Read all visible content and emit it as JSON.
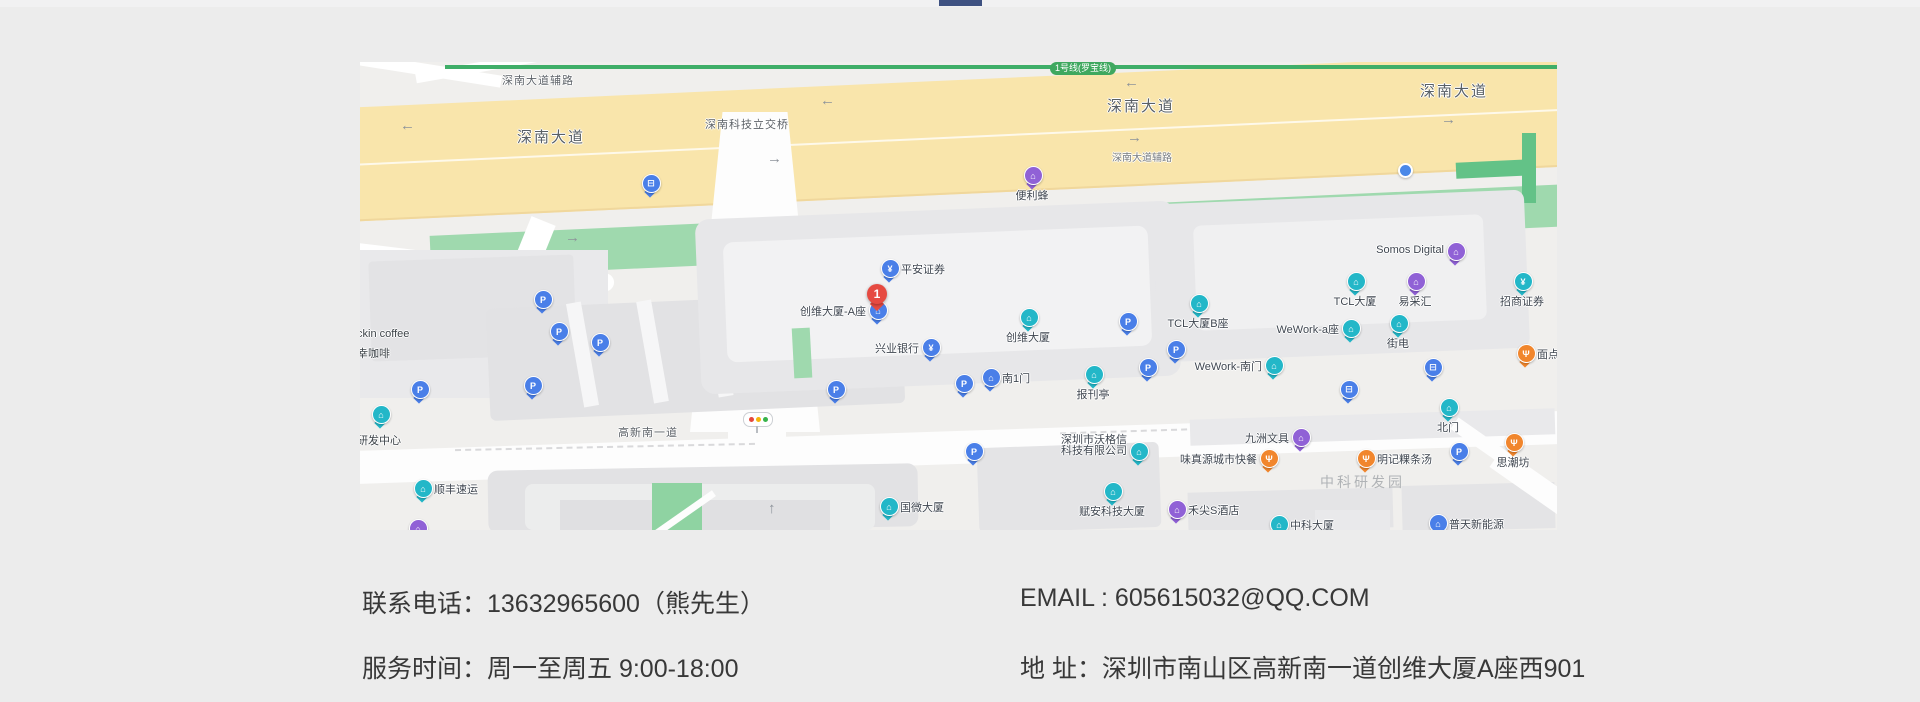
{
  "page": {
    "accent_color": "#3e5181"
  },
  "map": {
    "colors": {
      "teal": "#23b7c8",
      "blue": "#4a7fe8",
      "purple": "#9061d6",
      "orange": "#f1862d",
      "red": "#e64a41",
      "dotblue": "#4a88e8"
    },
    "metro_line_badge": "1号线(罗宝线)",
    "road_labels": [
      {
        "text": "深南大道辅路",
        "x": 142,
        "y": 10,
        "cls": "sm"
      },
      {
        "text": "深南大道",
        "x": 157,
        "y": 64,
        "cls": "lg"
      },
      {
        "text": "深南科技立交桥",
        "x": 345,
        "y": 54,
        "cls": "sm"
      },
      {
        "text": "深南大道",
        "x": 747,
        "y": 33,
        "cls": "lg"
      },
      {
        "text": "深南大道辅路",
        "x": 752,
        "y": 87,
        "cls": "xs"
      },
      {
        "text": "深南大道",
        "x": 1060,
        "y": 18,
        "cls": "lg"
      },
      {
        "text": "高新南一道",
        "x": 258,
        "y": 362,
        "cls": "sm"
      },
      {
        "text": "中科研发园",
        "x": 960,
        "y": 410,
        "cls": "area"
      },
      {
        "text": "ckin coffee",
        "x": -3,
        "y": 266,
        "cls": "poiLbl"
      },
      {
        "text": "幸咖啡",
        "x": -3,
        "y": 283,
        "cls": "poiLbl"
      },
      {
        "text": "想研发中心",
        "x": -14,
        "y": 370,
        "cls": "poiLbl"
      }
    ],
    "arrows": [
      {
        "dir": "left",
        "x": 40,
        "y": 55
      },
      {
        "dir": "right",
        "x": 205,
        "y": 167
      },
      {
        "dir": "left",
        "x": 460,
        "y": 30
      },
      {
        "dir": "right",
        "x": 407,
        "y": 88
      },
      {
        "dir": "left",
        "x": 764,
        "y": 12
      },
      {
        "dir": "right",
        "x": 767,
        "y": 67
      },
      {
        "dir": "right",
        "x": 1081,
        "y": 49
      },
      {
        "dir": "up",
        "x": 408,
        "y": 438
      }
    ],
    "marker": {
      "number": "1",
      "x": 517,
      "y": 250
    },
    "pois": [
      {
        "name": "bus-stop-pin",
        "label": "",
        "color": "blue",
        "glyph": "bus",
        "x": 290,
        "y": 126,
        "lp": "none"
      },
      {
        "name": "poi-bianlifeng",
        "label": "便利蜂",
        "color": "purple",
        "glyph": "building",
        "x": 672,
        "y": 118,
        "lp": "below"
      },
      {
        "name": "poi-pingan-securities",
        "label": "平安证券",
        "color": "blue",
        "glyph": "bank",
        "x": 529,
        "y": 211,
        "lp": "right"
      },
      {
        "name": "poi-skyworth-tower-a",
        "label": "创维大厦-A座",
        "color": "blue",
        "glyph": "building",
        "x": 517,
        "y": 253,
        "lp": "left"
      },
      {
        "name": "poi-cib-bank",
        "label": "兴业银行",
        "color": "blue",
        "glyph": "bank",
        "x": 570,
        "y": 290,
        "lp": "left"
      },
      {
        "name": "poi-skyworth-tower",
        "label": "创维大厦",
        "color": "teal",
        "glyph": "building",
        "x": 668,
        "y": 260,
        "lp": "below"
      },
      {
        "name": "poi-south-gate-1",
        "label": "南1门",
        "color": "blue",
        "glyph": "building",
        "x": 630,
        "y": 320,
        "lp": "right"
      },
      {
        "name": "poi-kiosk",
        "label": "报刊亭",
        "color": "teal",
        "glyph": "building",
        "x": 733,
        "y": 317,
        "lp": "below"
      },
      {
        "name": "parking-pin",
        "label": "",
        "color": "blue",
        "glyph": "parking",
        "x": 182,
        "y": 242,
        "lp": "none"
      },
      {
        "name": "parking-pin",
        "label": "",
        "color": "blue",
        "glyph": "parking",
        "x": 198,
        "y": 274,
        "lp": "none"
      },
      {
        "name": "parking-pin",
        "label": "",
        "color": "blue",
        "glyph": "parking",
        "x": 239,
        "y": 285,
        "lp": "none"
      },
      {
        "name": "parking-pin",
        "label": "",
        "color": "blue",
        "glyph": "parking",
        "x": 59,
        "y": 332,
        "lp": "none"
      },
      {
        "name": "parking-pin",
        "label": "",
        "color": "blue",
        "glyph": "parking",
        "x": 172,
        "y": 328,
        "lp": "none"
      },
      {
        "name": "parking-pin",
        "label": "",
        "color": "blue",
        "glyph": "parking",
        "x": 475,
        "y": 332,
        "lp": "none"
      },
      {
        "name": "parking-pin",
        "label": "",
        "color": "blue",
        "glyph": "parking",
        "x": 603,
        "y": 326,
        "lp": "none"
      },
      {
        "name": "parking-pin",
        "label": "",
        "color": "blue",
        "glyph": "parking",
        "x": 767,
        "y": 264,
        "lp": "none"
      },
      {
        "name": "parking-pin",
        "label": "",
        "color": "blue",
        "glyph": "parking",
        "x": 613,
        "y": 394,
        "lp": "none"
      },
      {
        "name": "parking-pin",
        "label": "",
        "color": "blue",
        "glyph": "parking",
        "x": 815,
        "y": 292,
        "lp": "none"
      },
      {
        "name": "parking-pin",
        "label": "",
        "color": "blue",
        "glyph": "parking",
        "x": 787,
        "y": 310,
        "lp": "none"
      },
      {
        "name": "parking-pin",
        "label": "",
        "color": "blue",
        "glyph": "parking",
        "x": 1098,
        "y": 394,
        "lp": "none"
      },
      {
        "name": "poi-guowei-tower",
        "label": "国微大厦",
        "color": "teal",
        "glyph": "building",
        "x": 528,
        "y": 449,
        "lp": "right"
      },
      {
        "name": "poi-wogexin-tech",
        "label": "深圳市沃格信科技有限公司",
        "color": "teal",
        "glyph": "building",
        "x": 778,
        "y": 394,
        "lp": "left2"
      },
      {
        "name": "poi-fuan-tech-tower",
        "label": "赋安科技大厦",
        "color": "teal",
        "glyph": "building",
        "x": 752,
        "y": 434,
        "lp": "below"
      },
      {
        "name": "poi-tcl-tower-b",
        "label": "TCL大厦B座",
        "color": "teal",
        "glyph": "building",
        "x": 838,
        "y": 246,
        "lp": "below"
      },
      {
        "name": "poi-tcl-tower",
        "label": "TCL大厦",
        "color": "teal",
        "glyph": "building",
        "x": 995,
        "y": 224,
        "lp": "below"
      },
      {
        "name": "poi-somos-digital",
        "label": "Somos Digital",
        "color": "purple",
        "glyph": "building",
        "x": 1095,
        "y": 194,
        "lp": "left"
      },
      {
        "name": "poi-yicaihui",
        "label": "易采汇",
        "color": "purple",
        "glyph": "building",
        "x": 1055,
        "y": 224,
        "lp": "below"
      },
      {
        "name": "poi-zhaoshang-securities",
        "label": "招商证券",
        "color": "teal",
        "glyph": "bank",
        "x": 1162,
        "y": 224,
        "lp": "below"
      },
      {
        "name": "poi-wework-a",
        "label": "WeWork-a座",
        "color": "teal",
        "glyph": "building",
        "x": 990,
        "y": 271,
        "lp": "left"
      },
      {
        "name": "poi-jiedian",
        "label": "街电",
        "color": "teal",
        "glyph": "building",
        "x": 1038,
        "y": 266,
        "lp": "below"
      },
      {
        "name": "poi-wework-south-gate",
        "label": "WeWork-南门",
        "color": "teal",
        "glyph": "building",
        "x": 913,
        "y": 308,
        "lp": "left"
      },
      {
        "name": "poi-miandian",
        "label": "面点",
        "color": "orange",
        "glyph": "food",
        "x": 1165,
        "y": 296,
        "lp": "right"
      },
      {
        "name": "bus-stop-pin",
        "label": "",
        "color": "blue",
        "glyph": "bus",
        "x": 1072,
        "y": 310,
        "lp": "none"
      },
      {
        "name": "bus-stop-pin",
        "label": "",
        "color": "blue",
        "glyph": "bus",
        "x": 988,
        "y": 332,
        "lp": "none"
      },
      {
        "name": "poi-north-gate",
        "label": "北门",
        "color": "teal",
        "glyph": "building",
        "x": 1088,
        "y": 350,
        "lp": "below"
      },
      {
        "name": "poi-jiuzhou-stationery",
        "label": "九洲文具",
        "color": "purple",
        "glyph": "building",
        "x": 940,
        "y": 380,
        "lp": "left"
      },
      {
        "name": "poi-weizhenyuan-fastfood",
        "label": "味真源城市快餐",
        "color": "orange",
        "glyph": "food",
        "x": 908,
        "y": 401,
        "lp": "left"
      },
      {
        "name": "poi-mingji-noodles",
        "label": "明记粿条汤",
        "color": "orange",
        "glyph": "food",
        "x": 1005,
        "y": 401,
        "lp": "right"
      },
      {
        "name": "poi-sichaofang",
        "label": "思潮坊",
        "color": "orange",
        "glyph": "food",
        "x": 1153,
        "y": 385,
        "lp": "below"
      },
      {
        "name": "poi-hejian-hotel",
        "label": "禾尖S酒店",
        "color": "purple",
        "glyph": "building",
        "x": 816,
        "y": 452,
        "lp": "right"
      },
      {
        "name": "poi-zhongke-tower",
        "label": "中科大厦",
        "color": "teal",
        "glyph": "building",
        "x": 918,
        "y": 467,
        "lp": "right"
      },
      {
        "name": "poi-putian-energy",
        "label": "普天新能源",
        "color": "blue",
        "glyph": "building",
        "x": 1077,
        "y": 466,
        "lp": "right"
      },
      {
        "name": "poi-sf-express",
        "label": "顺丰速运",
        "color": "teal",
        "glyph": "building",
        "x": 62,
        "y": 431,
        "lp": "right"
      },
      {
        "name": "poi-rnd-center-pin",
        "label": "",
        "color": "teal",
        "glyph": "building",
        "x": 20,
        "y": 357,
        "lp": "none"
      },
      {
        "name": "metro-station-dot",
        "label": "",
        "color": "dotblue",
        "glyph": "dot",
        "x": 1045,
        "y": 108,
        "lp": "none"
      },
      {
        "name": "poi-pin-partial",
        "label": "",
        "color": "purple",
        "glyph": "building",
        "x": 57,
        "y": 471,
        "lp": "none"
      }
    ]
  },
  "contact": {
    "phone": "联系电话：13632965600（熊先生）",
    "email": "EMAIL : 605615032@QQ.COM",
    "hours": "服务时间：周一至周五 9:00-18:00",
    "address": "地 址：深圳市南山区高新南一道创维大厦A座西901"
  }
}
